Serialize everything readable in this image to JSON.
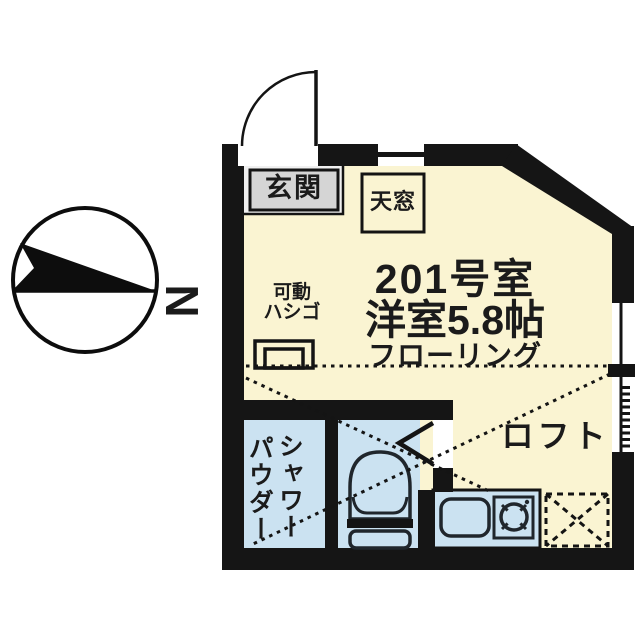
{
  "plan": {
    "room_number": "201号室",
    "room_type": "洋室5.8帖",
    "flooring": "フローリング",
    "entrance": "玄関",
    "skylight": "天窓",
    "movable_ladder_line1": "可動",
    "movable_ladder_line2": "ハシゴ",
    "loft": "ロフト",
    "shower": "シャワー",
    "powder": "パウダー"
  },
  "compass": {
    "north_label": "N"
  },
  "colors": {
    "wall": "#151515",
    "room_fill": "#FAF4D2",
    "wet_area_fill": "#CBE2F1",
    "entrance_fill": "#F0F0F0",
    "entrance_box_fill": "#D5D5D5",
    "line": "#141414"
  }
}
